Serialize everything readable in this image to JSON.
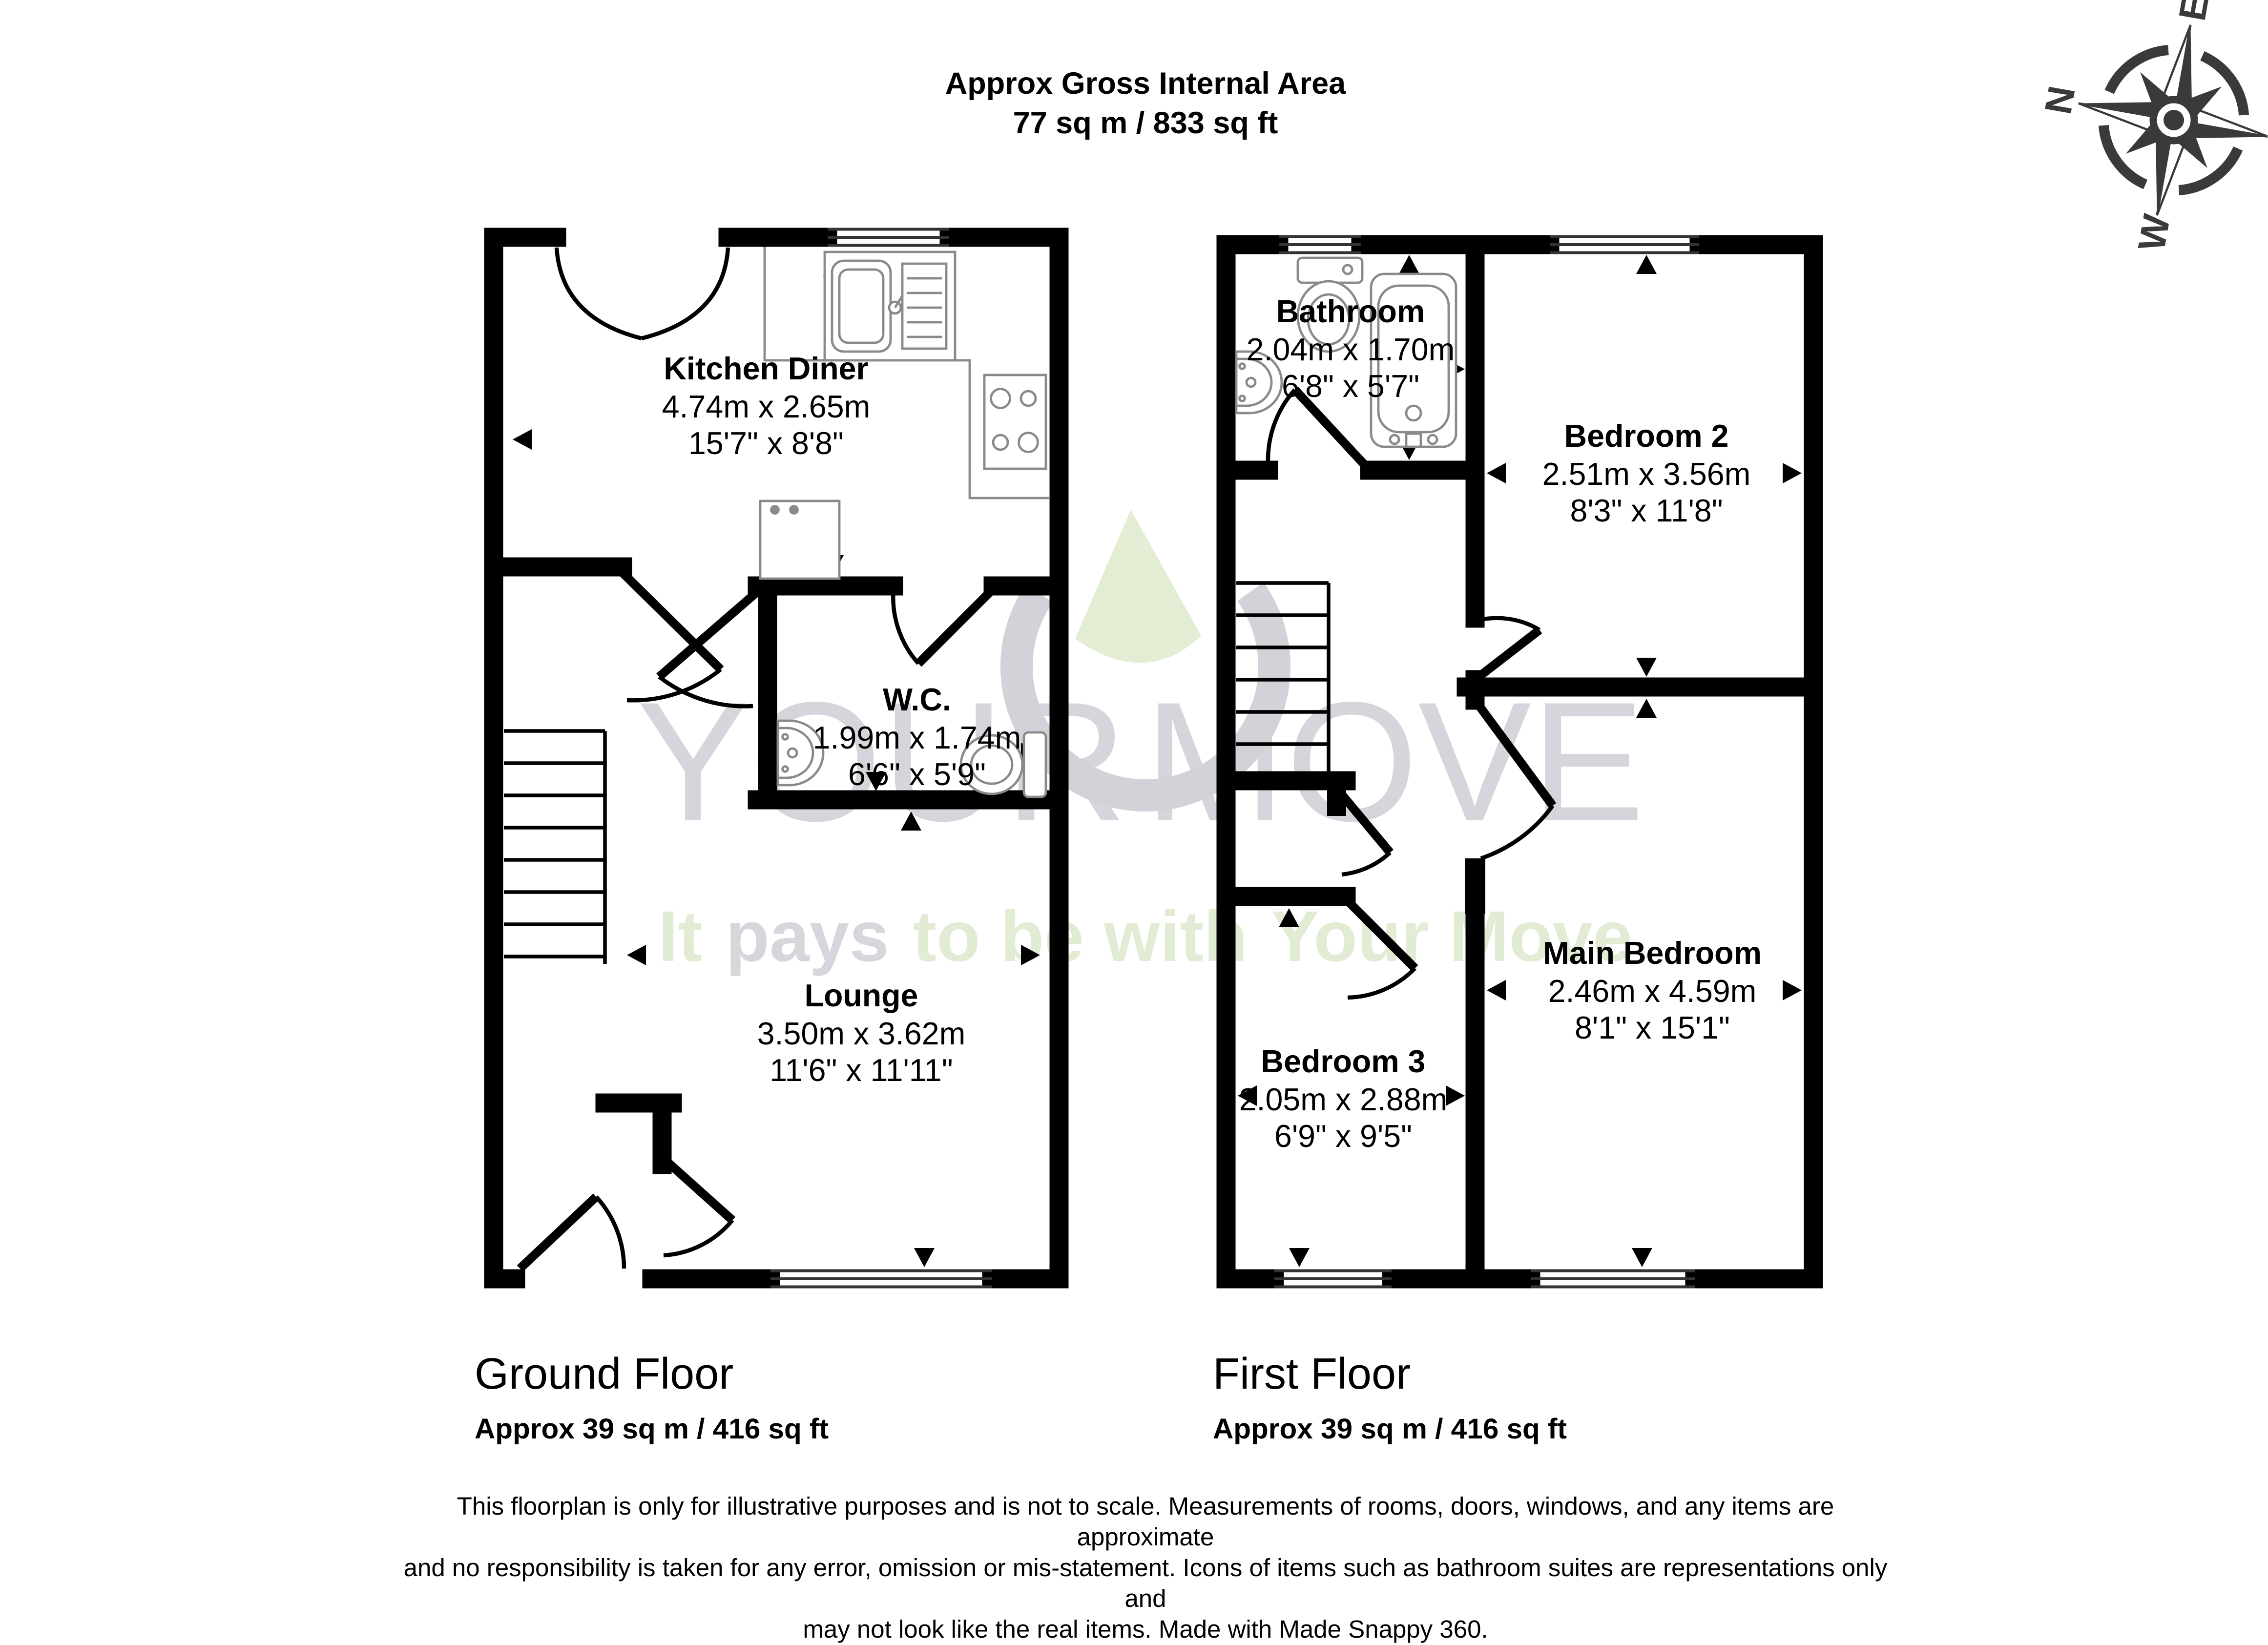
{
  "header": {
    "line1": "Approx Gross Internal Area",
    "line2": "77 sq m / 833 sq ft"
  },
  "compass": {
    "n": "N",
    "e": "E",
    "s": "S",
    "w": "W"
  },
  "watermark": {
    "big_left": "YOUR",
    "big_right": "MOVE",
    "tag1": "It",
    "tag2": "pays",
    "tag3": "to be with",
    "tag4": "Your Move",
    "brand_green": "#e2ecd4",
    "brand_gray": "#d6d6dc"
  },
  "ground_floor": {
    "title": "Ground Floor",
    "area": "Approx 39 sq m / 416 sq ft",
    "rooms": {
      "kitchen": {
        "name": "Kitchen Diner",
        "metric": "4.74m x 2.65m",
        "imperial": "15'7\" x 8'8\""
      },
      "wc": {
        "name": "W.C.",
        "metric": "1.99m x 1.74m",
        "imperial": "6'6\" x 5'9\""
      },
      "lounge": {
        "name": "Lounge",
        "metric": "3.50m x 3.62m",
        "imperial": "11'6\" x 11'11\""
      }
    }
  },
  "first_floor": {
    "title": "First Floor",
    "area": "Approx 39 sq m / 416 sq ft",
    "rooms": {
      "bathroom": {
        "name": "Bathroom",
        "metric": "2.04m x 1.70m",
        "imperial": "6'8\" x 5'7\""
      },
      "bedroom2": {
        "name": "Bedroom 2",
        "metric": "2.51m x 3.56m",
        "imperial": "8'3\" x 11'8\""
      },
      "bedroom3": {
        "name": "Bedroom 3",
        "metric": "2.05m x 2.88m",
        "imperial": "6'9\" x 9'5\""
      },
      "main_bedroom": {
        "name": "Main Bedroom",
        "metric": "2.46m x 4.59m",
        "imperial": "8'1\" x 15'1\""
      }
    }
  },
  "disclaimer": {
    "line1": "This floorplan is only for illustrative purposes and is not to scale. Measurements of rooms, doors, windows, and any items are approximate",
    "line2": "and no responsibility is taken for any error, omission or mis-statement. Icons of items such as bathroom suites are representations only and",
    "line3": "may not look like the real items. Made with Made Snappy 360."
  }
}
